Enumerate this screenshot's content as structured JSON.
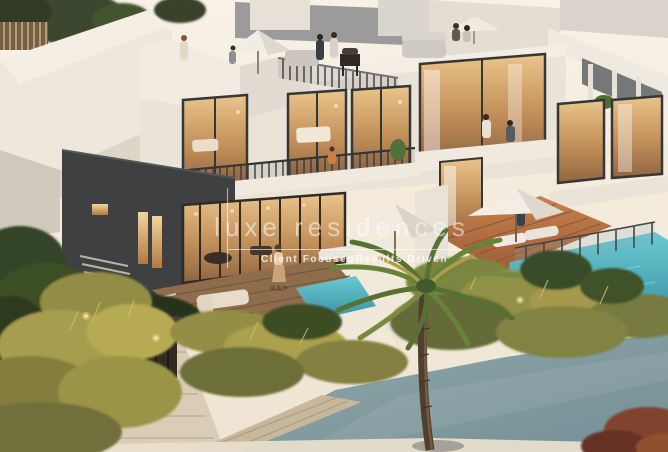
{
  "scene": {
    "type": "architectural-render-photo",
    "description": "Twilight 3D rendering of modern two-storey villas with a rooftop lounge terrace, warm lit floor-to-ceiling windows, private turquoise pools, timber deck with outdoor furniture, a tall palm tree, golden ornamental grasses and a wide blue-grey walkway in the foreground",
    "palette": {
      "sky": "#f4eee3",
      "wall_white": "#ece7de",
      "wall_dark": "#34383c",
      "window_glow": "#d8a468",
      "pool_turquoise": "#41a8b7",
      "deck_terracotta": "#b4693c",
      "timber_deck": "#8a6847",
      "grass_gold": "#b3a84f",
      "grass_green": "#56622e",
      "palm_green": "#4f6e2e",
      "walkway_blue_grey": "#7e9aa2",
      "path_beige": "#d9cfba",
      "shrub_red": "#7a3a26"
    }
  },
  "watermark": {
    "wordmark": "luxe residences",
    "tagline_left": "Client Focused",
    "tagline_right": "Results Driven",
    "color": "#ffffff"
  }
}
